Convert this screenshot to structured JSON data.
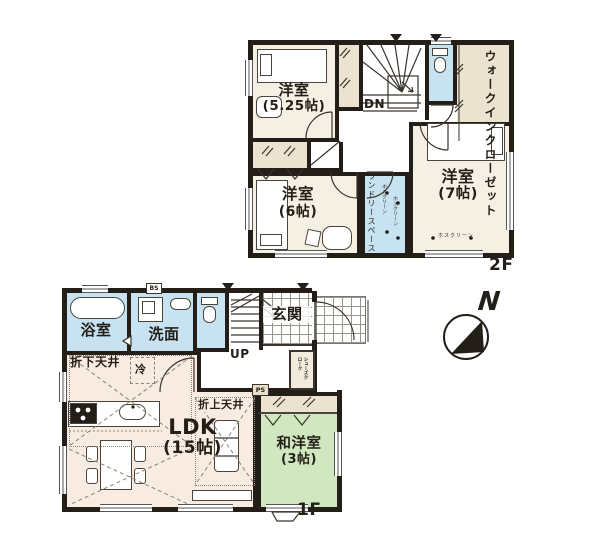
{
  "floor2": {
    "floor_label": "2F",
    "room_525": {
      "name": "洋室",
      "size": "(5.25帖)"
    },
    "wic": "ウォークインクローゼット",
    "dn": "DN",
    "room_6": {
      "name": "洋室",
      "size": "(6帖)"
    },
    "laundry": "ランドリースペース",
    "hoscreen": "ホスクリーン",
    "room_7": {
      "name": "洋室",
      "size": "(7帖)"
    }
  },
  "floor1": {
    "floor_label": "1F",
    "bath": "浴室",
    "wash": "洗面",
    "bs": "BS",
    "entrance": "玄関",
    "up": "UP",
    "ceiling_lowered": "折下天井",
    "fridge": "冷",
    "ceiling_raised": "折上天井",
    "ldk": {
      "name": "LDK",
      "size": "(15帖)"
    },
    "tatami": {
      "name": "和洋室",
      "size": "(3帖)"
    },
    "ps": "PS",
    "shoe_closet": "シューズクローク"
  },
  "compass": {
    "north": "N"
  },
  "colors": {
    "wall": "#241e19",
    "room_cream": "#f4f0e3",
    "closet_tan": "#ebe3cf",
    "water_blue": "#c7e3f2",
    "ldk_pink": "#f8ebe1",
    "tatami_green": "#d0e7c0"
  }
}
